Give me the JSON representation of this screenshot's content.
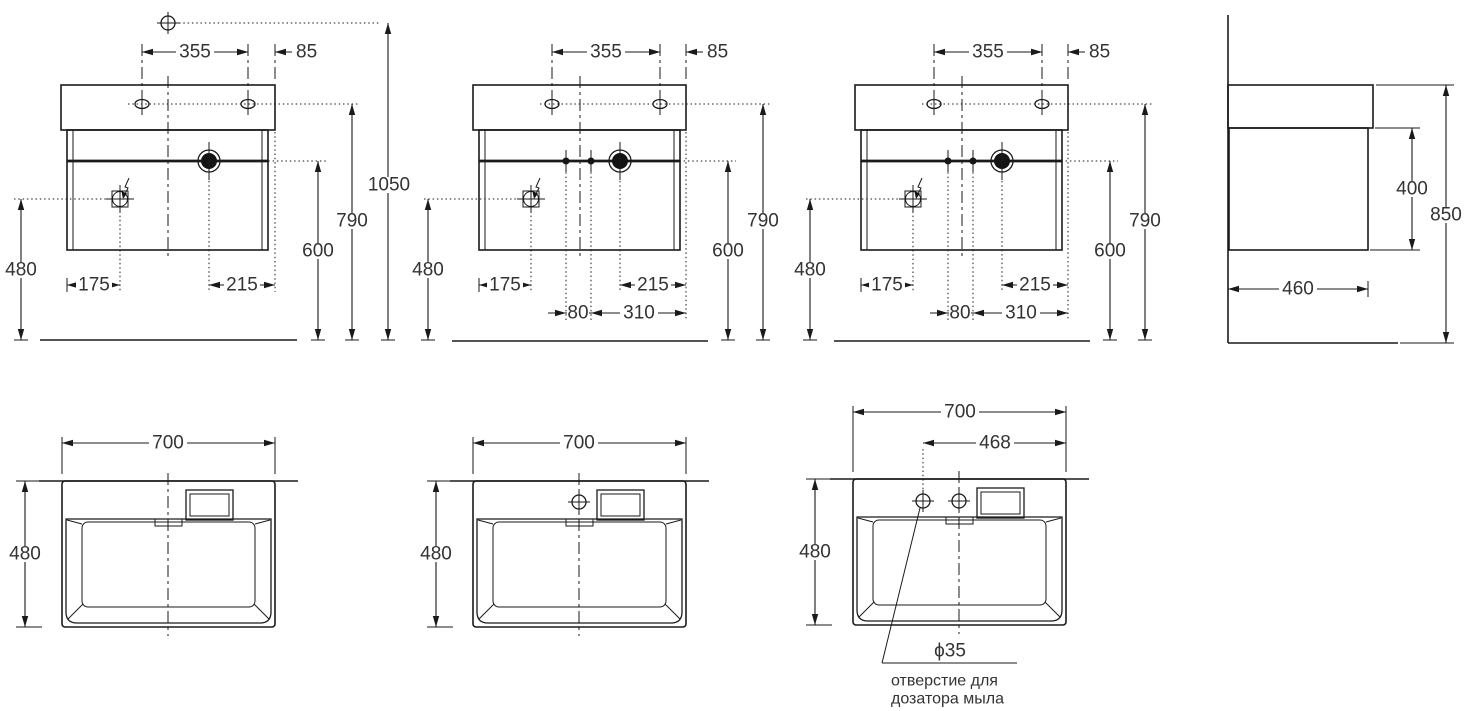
{
  "front": {
    "dim_hole_spacing": "355",
    "dim_edge_offset": "85",
    "dim_mixer_height": "1050",
    "dim_holes_height": "790",
    "dim_siphon_height": "600",
    "dim_outlet_height": "480",
    "dim_outlet_offset": "175",
    "dim_siphon_offset": "215",
    "dim_supply_spacing": "80",
    "dim_supply_offset": "310"
  },
  "side": {
    "dim_cabinet_height": "400",
    "dim_total_height": "850",
    "dim_depth": "460"
  },
  "plan": {
    "dim_width": "700",
    "dim_depth": "480",
    "dim_dispenser_offset": "468",
    "dispenser_hole_diameter": "ϕ35",
    "dispenser_note_line1": "отверстие для",
    "dispenser_note_line2": "дозатора мыла"
  }
}
